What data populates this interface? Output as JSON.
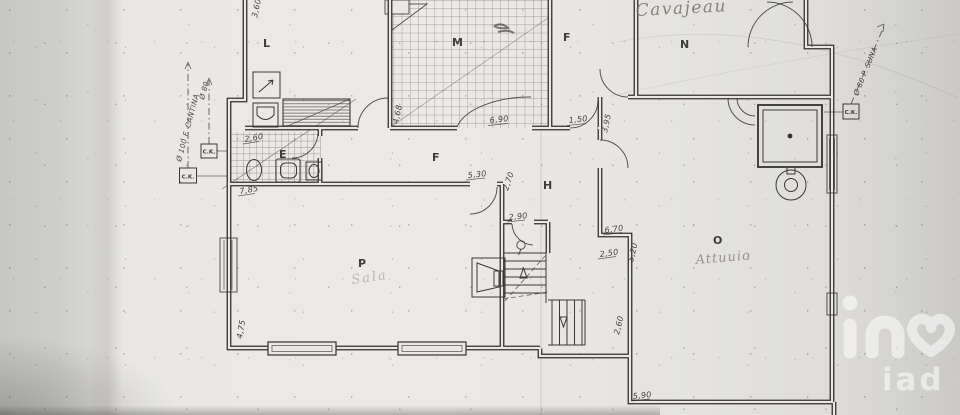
{
  "rooms": {
    "l": "L",
    "m": "M",
    "f_top": "F",
    "n": "N",
    "f_mid": "F",
    "h": "H",
    "e": "E",
    "p": "P",
    "o": "O"
  },
  "handwritten": {
    "top_note": "Cavajeau",
    "room_p_note": "Sala",
    "room_o_note": "Attuuio"
  },
  "measurements": {
    "upper_left_wall": "3,60",
    "bath_width": "2,60",
    "bath_total": "7,85",
    "m_left": "4,68",
    "m_width": "6,90",
    "f_door": "1,50",
    "f_right": "3,95",
    "corridor_wall": "5,30",
    "corridor_depth": "2,70",
    "stair_door": "2,90",
    "o_top": "6,70",
    "o_upper": "2,50",
    "o_left": "5,20",
    "o_step": "2,60",
    "o_bottom": "5,90",
    "p_left": "4,75"
  },
  "flues": {
    "left_primary": "Ø 100 F. CANTINA",
    "left_secondary": "Ø 80",
    "right": "Ø 80 P. SUNA",
    "box_label": "C.K."
  },
  "watermark": {
    "text": "iad"
  }
}
